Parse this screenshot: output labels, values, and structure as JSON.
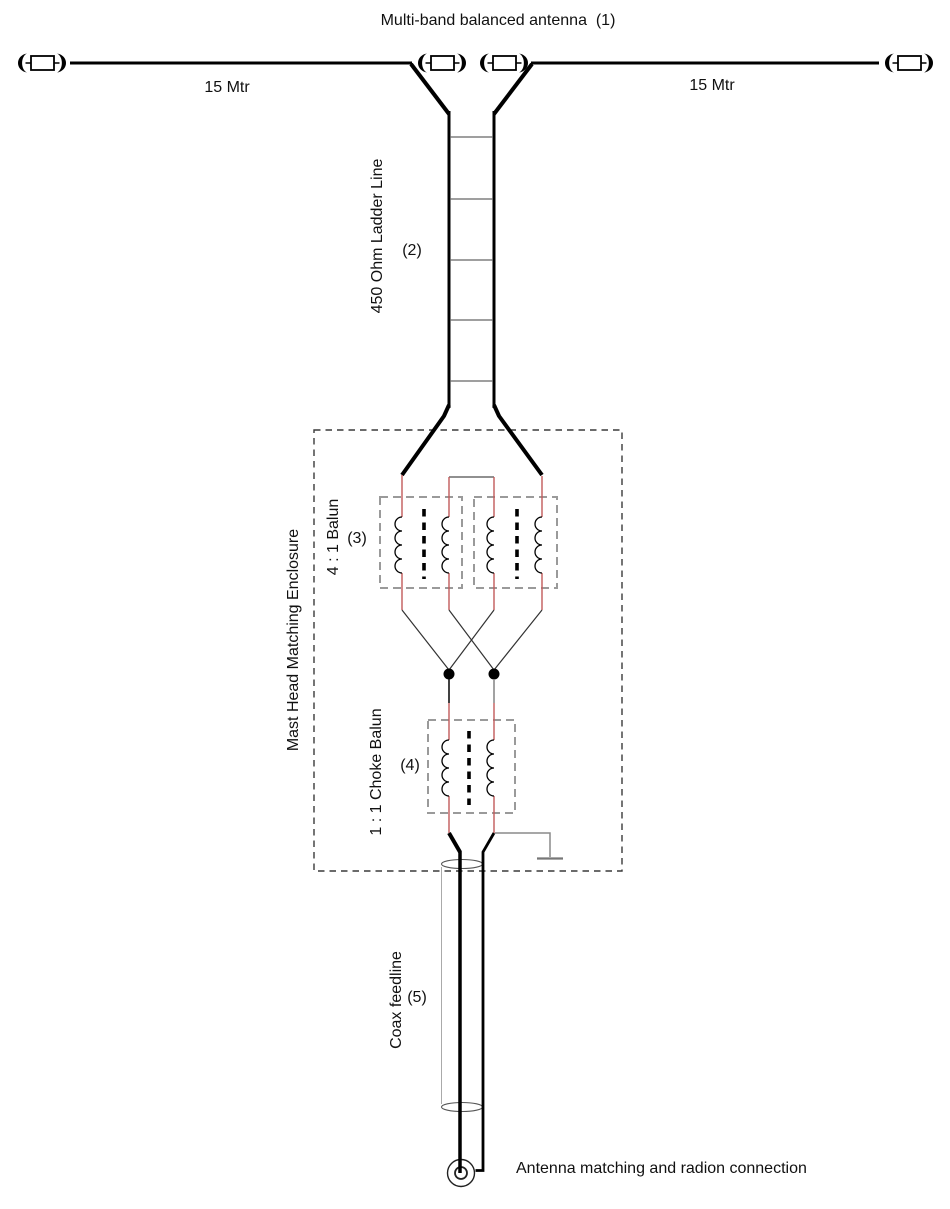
{
  "diagram": {
    "title": "Multi-band balanced antenna  (1)",
    "labels": {
      "wire_left": "15 Mtr",
      "wire_right": "15 Mtr",
      "ladder_line": "450 Ohm Ladder Line",
      "ladder_line_ref": "(2)",
      "enclosure": "Mast Head Matching Enclosure",
      "balun_4_1": "4 : 1 Balun",
      "balun_4_1_ref": "(3)",
      "choke_balun": "1 : 1 Choke Balun",
      "choke_balun_ref": "(4)",
      "coax_feedline": "Coax feedline",
      "coax_feedline_ref": "(5)",
      "connection": "Antenna matching and radion connection"
    },
    "colors": {
      "wire": "#000000",
      "winding_wire": "#c25a5a",
      "enclosure_dash": "#3a3a3a",
      "component_box_dash": "#9a9a9a",
      "ground_wire": "#8a8a8a"
    }
  }
}
